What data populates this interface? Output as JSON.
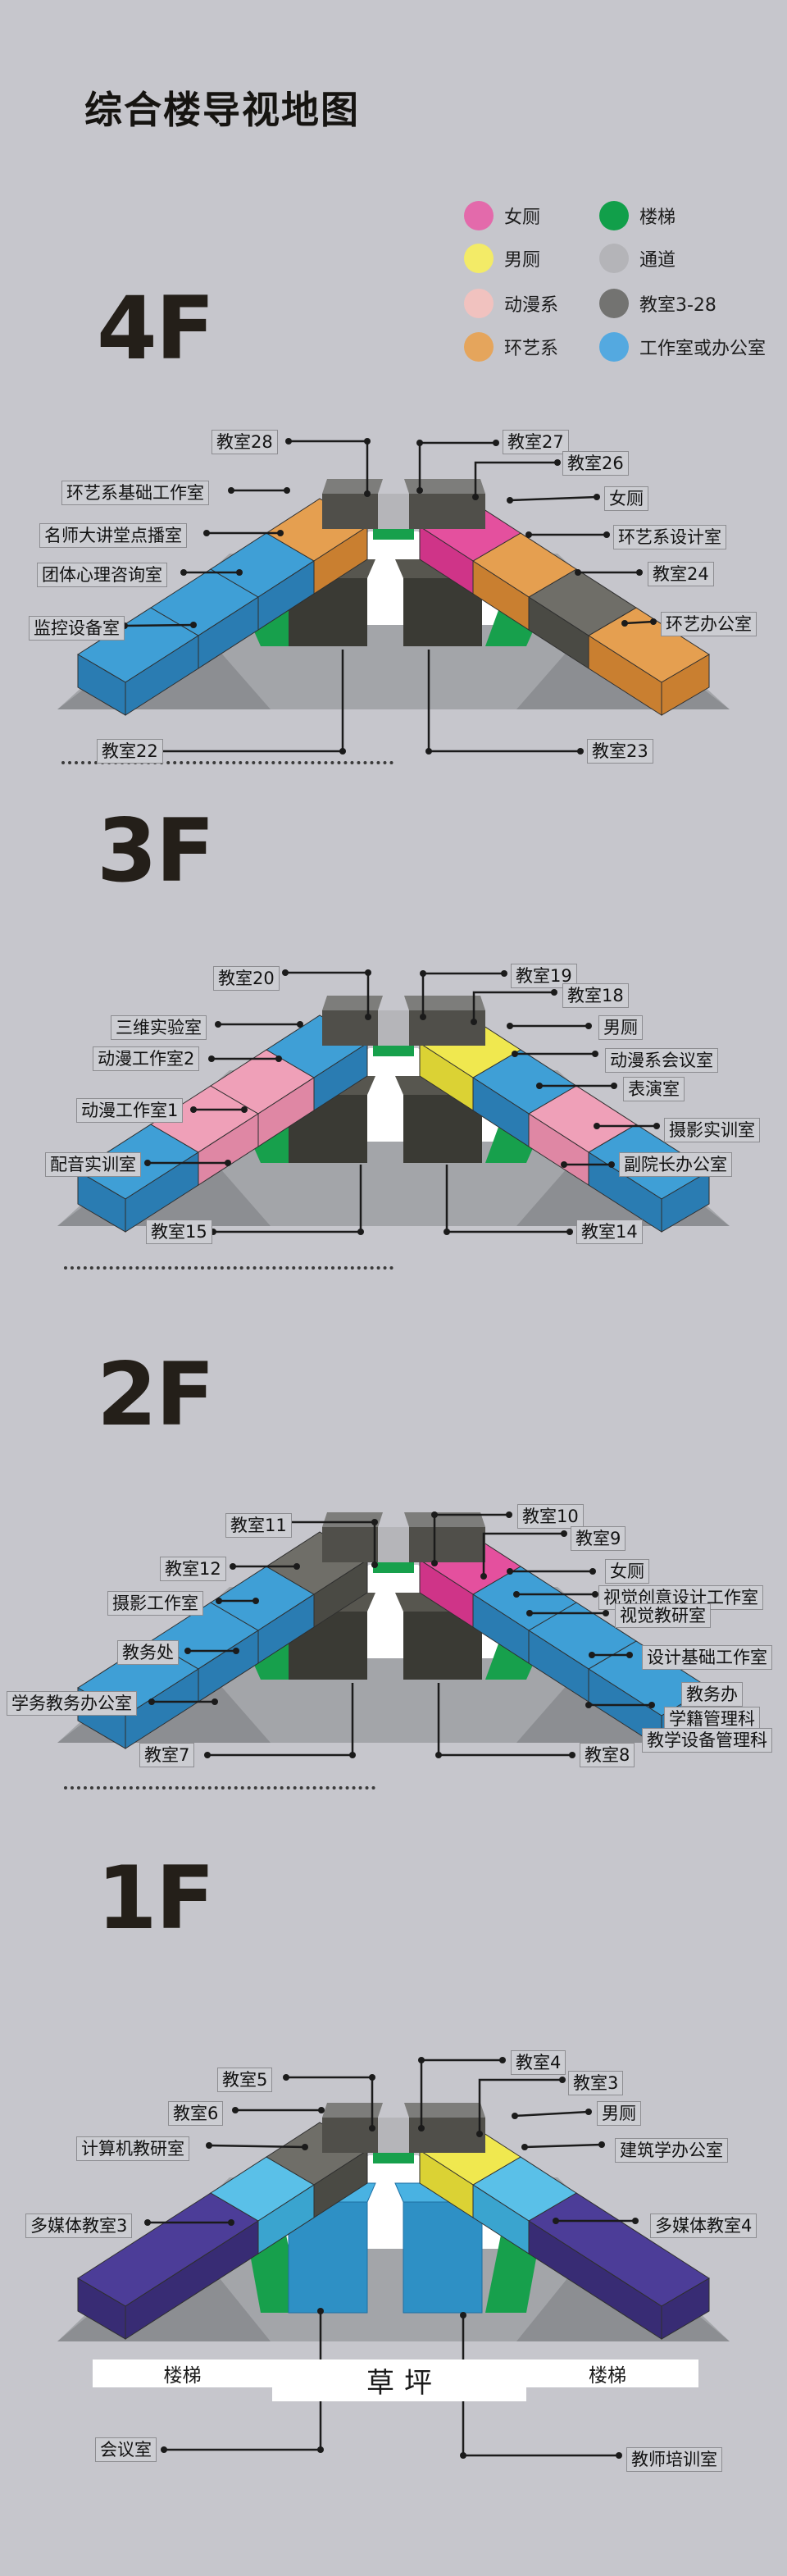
{
  "page": {
    "title": "综合楼导视地图",
    "background": "#c6c6cc"
  },
  "legend": {
    "items": [
      {
        "label": "女厕",
        "color": "#e36aab"
      },
      {
        "label": "男厕",
        "color": "#f3eb67"
      },
      {
        "label": "动漫系",
        "color": "#f1c2bf"
      },
      {
        "label": "环艺系",
        "color": "#e5a55c"
      },
      {
        "label": "楼梯",
        "color": "#119f4a"
      },
      {
        "label": "通道",
        "color": "#b4b4b8"
      },
      {
        "label": "教室3-28",
        "color": "#737371"
      },
      {
        "label": "工作室或办公室",
        "color": "#54a9e0"
      }
    ]
  },
  "floors": [
    {
      "name": "4F",
      "labels": [
        "教室28",
        "教室27",
        "教室26",
        "女厕",
        "环艺系设计室",
        "教室24",
        "环艺办公室",
        "环艺系基础工作室",
        "名师大讲堂点播室",
        "团体心理咨询室",
        "监控设备室",
        "教室22",
        "教室23"
      ]
    },
    {
      "name": "3F",
      "labels": [
        "教室20",
        "教室19",
        "教室18",
        "男厕",
        "动漫系会议室",
        "表演室",
        "摄影实训室",
        "副院长办公室",
        "三维实验室",
        "动漫工作室2",
        "动漫工作室1",
        "配音实训室",
        "教室15",
        "教室14"
      ]
    },
    {
      "name": "2F",
      "labels": [
        "教室11",
        "教室10",
        "教室9",
        "女厕",
        "视觉创意设计工作室",
        "视觉教研室",
        "设计基础工作室",
        "教务办",
        "学籍管理科",
        "教学设备管理科",
        "教室12",
        "摄影工作室",
        "教务处",
        "学务教务办公室",
        "教室7",
        "教室8"
      ]
    },
    {
      "name": "1F",
      "labels": [
        "教室5",
        "教室4",
        "教室3",
        "男厕",
        "教室6",
        "计算机教研室",
        "建筑学办公室",
        "多媒体教室3",
        "多媒体教室4",
        "楼梯",
        "草坪",
        "楼梯",
        "会议室",
        "教师培训室"
      ]
    }
  ]
}
